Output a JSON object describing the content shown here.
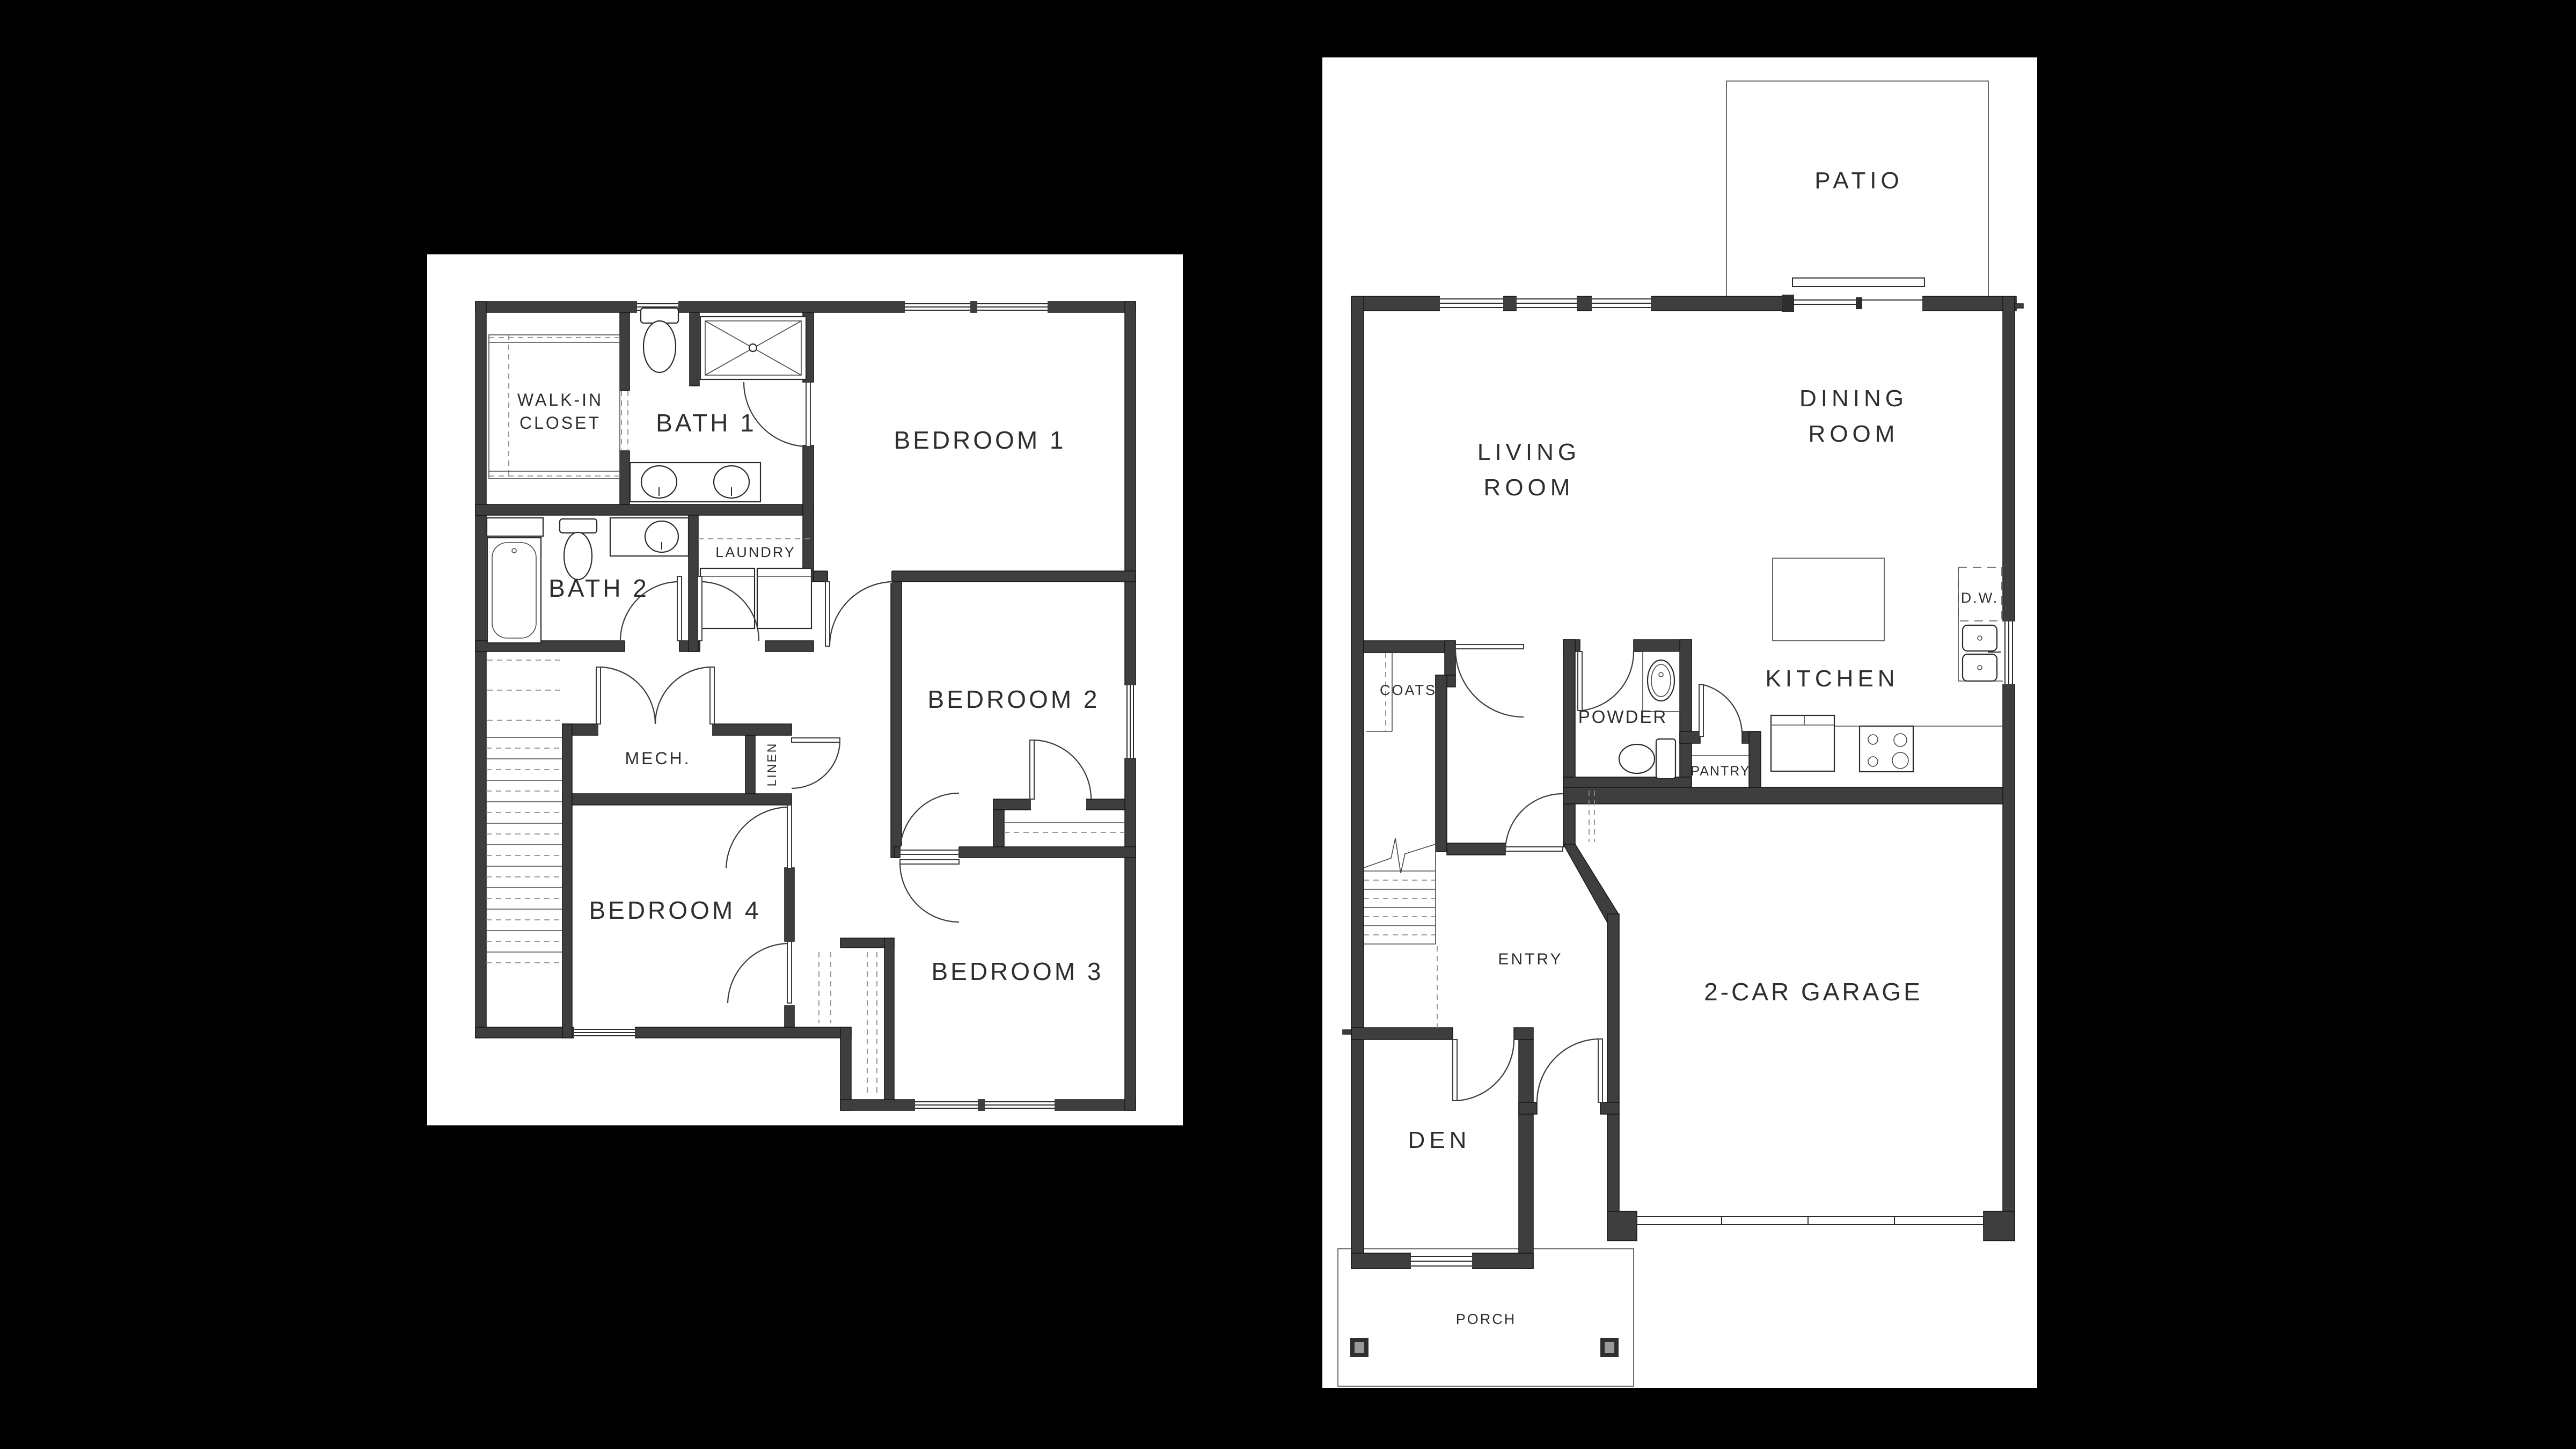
{
  "page": {
    "background": "#000000",
    "panel_background": "#ffffff"
  },
  "colors": {
    "wall": "#3e3e3e",
    "thin_line": "#2b2b2b",
    "dashed_line": "#7a7a7a",
    "text": "#2e2e2e"
  },
  "floor2": {
    "labels": {
      "walk_in_1": "WALK-IN",
      "walk_in_2": "CLOSET",
      "bath1": "BATH 1",
      "bedroom1": "BEDROOM 1",
      "bath2": "BATH 2",
      "laundry": "LAUNDRY",
      "bedroom2": "BEDROOM 2",
      "mech": "MECH.",
      "linen": "LINEN",
      "bedroom4": "BEDROOM 4",
      "bedroom3": "BEDROOM 3"
    }
  },
  "floor1": {
    "labels": {
      "patio": "PATIO",
      "living_1": "LIVING",
      "living_2": "ROOM",
      "dining_1": "DINING",
      "dining_2": "ROOM",
      "dw": "D.W.",
      "kitchen": "KITCHEN",
      "coats": "COATS",
      "powder": "POWDER",
      "pantry": "PANTRY",
      "entry": "ENTRY",
      "garage": "2-CAR GARAGE",
      "den": "DEN",
      "porch": "PORCH"
    }
  }
}
